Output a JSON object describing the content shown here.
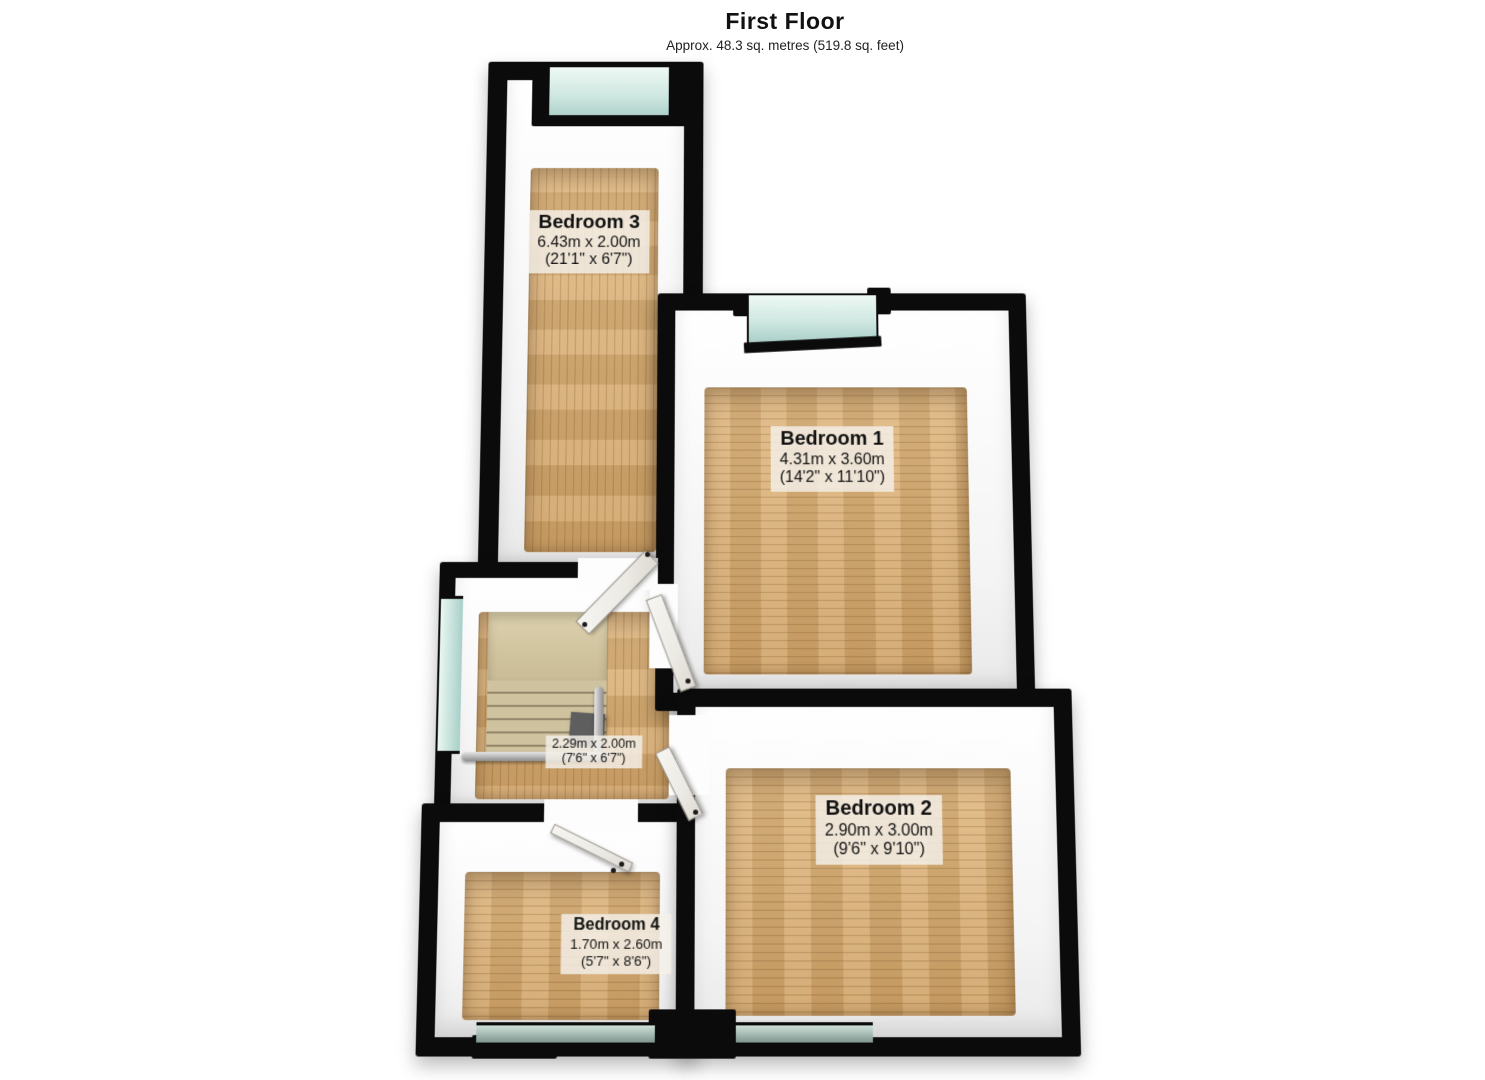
{
  "header": {
    "title": "First Floor",
    "subtitle": "Approx. 48.3 sq. metres (519.8 sq. feet)"
  },
  "rooms": [
    {
      "name": "Bedroom 3",
      "metric": "6.43m x 2.00m",
      "imperial": "(21'1\" x 6'7\")"
    },
    {
      "name": "Bedroom 1",
      "metric": "4.31m x 3.60m",
      "imperial": "(14'2\" x 11'10\")"
    },
    {
      "name": "Bedroom 2",
      "metric": "2.90m x 3.00m",
      "imperial": "(9'6\" x 9'10\")"
    },
    {
      "name": "Bedroom 4",
      "metric": "1.70m x 2.60m",
      "imperial": "(5'7\" x 8'6\")"
    },
    {
      "name": "Landing",
      "metric": "2.29m x 2.00m",
      "imperial": "(7'6\" x 6'7\")"
    }
  ],
  "palette": {
    "wall": "#0b0b0b",
    "wall_face": "#ffffff",
    "floor_wood": "#d6a96f",
    "window_glass": "#bfe0d9",
    "stairs": "#cfc29e",
    "handrail": "#b5b5b5",
    "label_background": "#f4f0e8"
  }
}
